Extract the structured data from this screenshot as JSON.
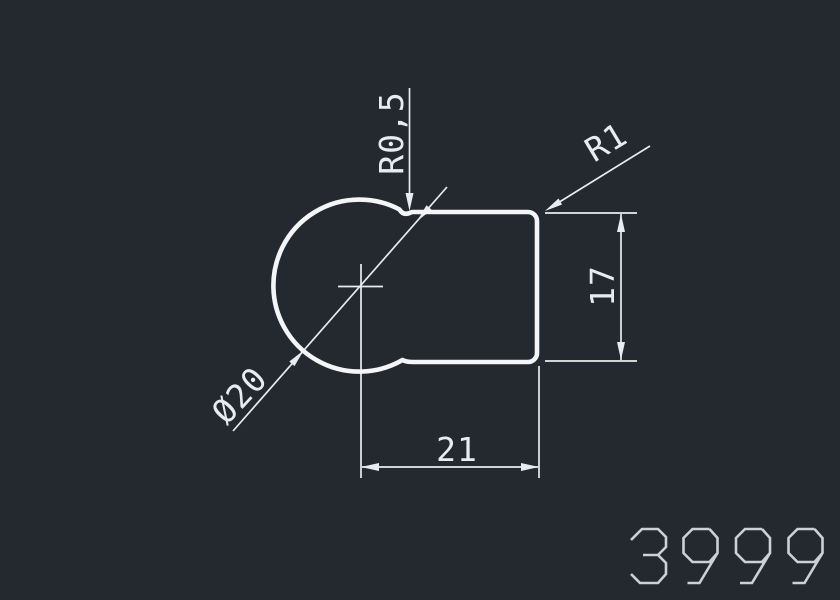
{
  "app": {
    "name": "cad-viewport",
    "background_color": "#24282f",
    "line_color": "#f4f5f7",
    "dim_color": "#e9ecef",
    "number_color": "#ccd1d8"
  },
  "drawing": {
    "dimensions": {
      "fillet_top": "R0,5",
      "fillet_corner": "R1",
      "height": "17",
      "width": "21",
      "diameter": "Ø20"
    },
    "drawing_number": "3999"
  }
}
